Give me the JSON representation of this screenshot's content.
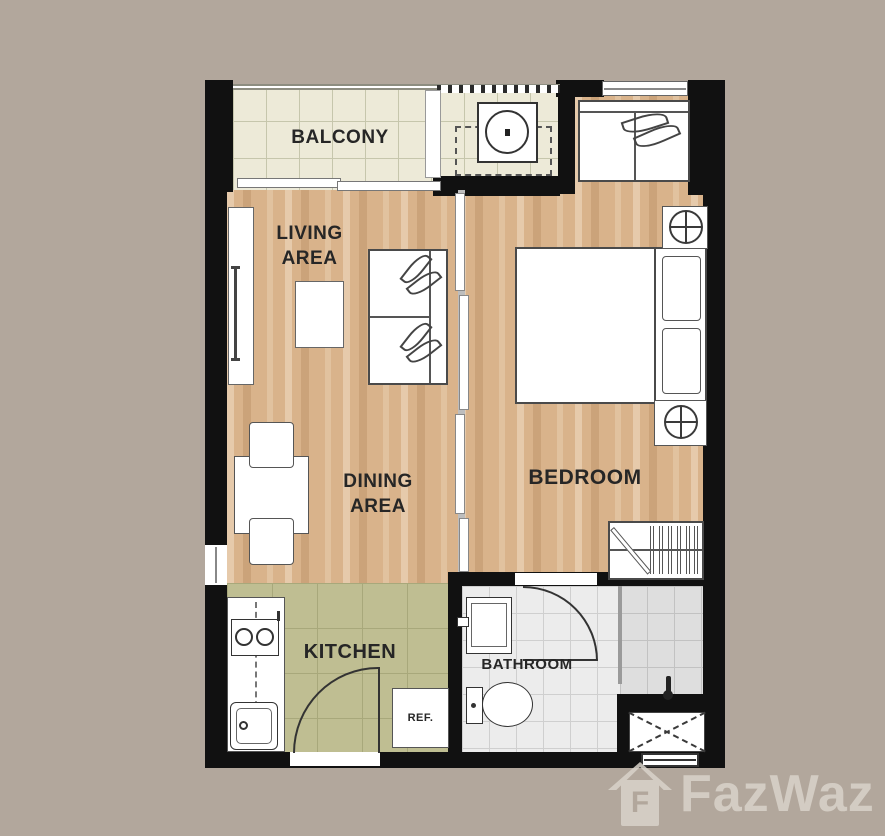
{
  "plan": {
    "type": "apartment-floor-plan",
    "rooms": {
      "balcony": {
        "label": "BALCONY"
      },
      "living_area": {
        "line1": "LIVING",
        "line2": "AREA"
      },
      "dining_area": {
        "line1": "DINING",
        "line2": "AREA"
      },
      "bedroom": {
        "label": "BEDROOM"
      },
      "kitchen": {
        "label": "KITCHEN"
      },
      "bathroom": {
        "label": "BATHROOM"
      }
    },
    "furniture_labels": {
      "refrigerator": "REF."
    }
  },
  "watermark": {
    "brand": "FazWaz",
    "icon_letter": "F"
  },
  "colors": {
    "background": "#b2a79c",
    "wall": "#111111",
    "wood_floor": "#d9b38b",
    "balcony_tile": "#edead8",
    "kitchen_tile": "#bfbe92",
    "bathroom_tile": "#ececec",
    "label_text": "#262626",
    "watermark": "#d9d3ca"
  }
}
